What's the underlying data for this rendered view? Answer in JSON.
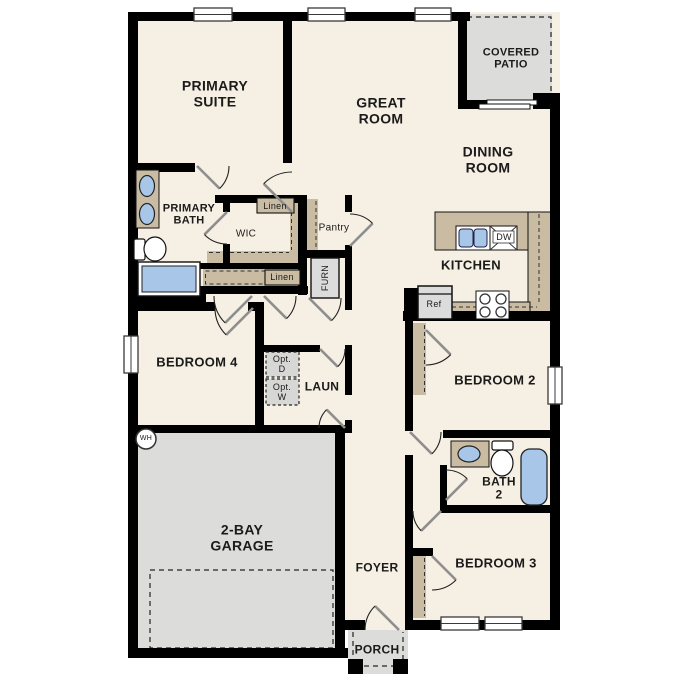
{
  "labels": {
    "primary_suite": "PRIMARY SUITE",
    "great_room": "GREAT ROOM",
    "covered_patio": "COVERED PATIO",
    "dining_room": "DINING ROOM",
    "kitchen": "KITCHEN",
    "primary_bath": "PRIMARY BATH",
    "wic": "WIC",
    "linen_upper": "Linen",
    "linen_lower": "Linen",
    "pantry": "Pantry",
    "furnace": "FURN",
    "bedroom_4": "BEDROOM 4",
    "opt_dryer": "Opt. D",
    "opt_washer": "Opt. W",
    "laundry": "LAUN",
    "water_heater": "WH",
    "garage": "2-BAY GARAGE",
    "foyer": "FOYER",
    "porch": "PORCH",
    "bedroom_2": "BEDROOM 2",
    "bath_2": "BATH 2",
    "bedroom_3": "BEDROOM 3",
    "refrigerator": "Ref",
    "dishwasher": "DW"
  },
  "colors": {
    "floor": "#F6EFE3",
    "wall": "#000000",
    "counter_tan": "#C9BCA2",
    "concrete_gray": "#DCDCDA",
    "fixture_blue": "#A8C7E8",
    "appliance_gray": "#DCDCDC"
  }
}
